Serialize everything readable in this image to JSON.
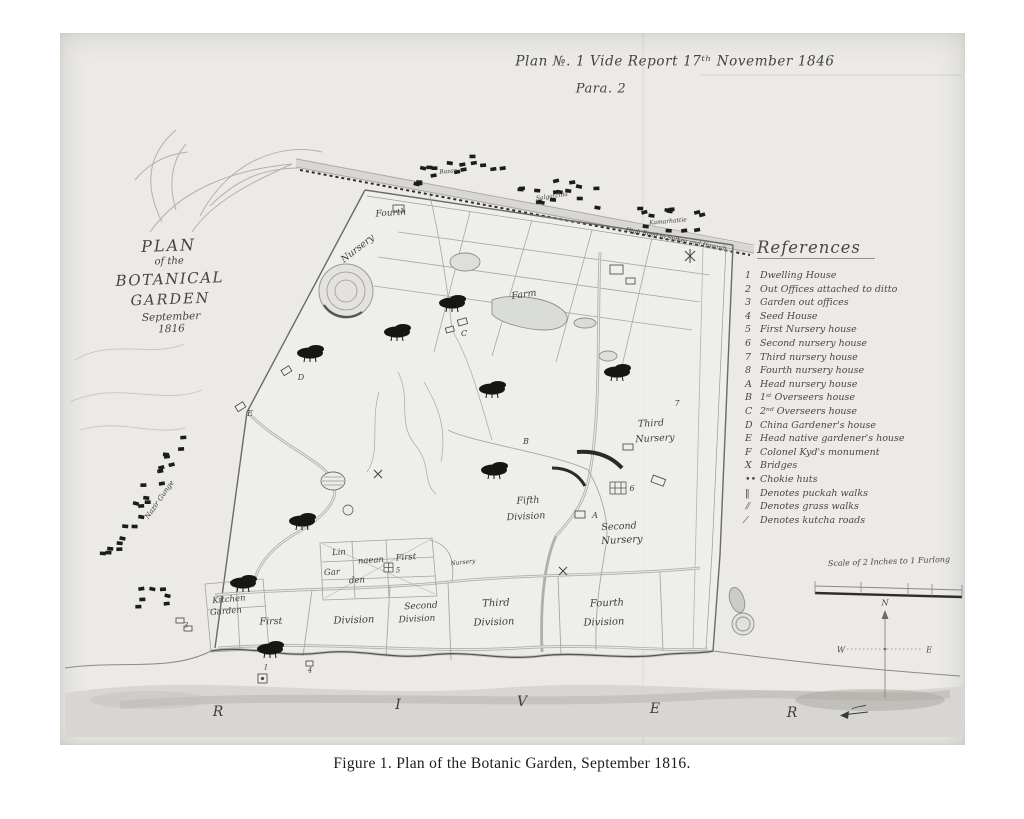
{
  "header": {
    "line1": "Plan №. 1 Vide Report 17ᵗʰ November 1846",
    "line2": "Para. 2"
  },
  "title_block": {
    "lines": [
      "PLAN",
      "of the",
      "BOTANICAL",
      "GARDEN",
      "September",
      "1816"
    ]
  },
  "references": {
    "heading": "References",
    "items": [
      {
        "key": "1",
        "text": "Dwelling House"
      },
      {
        "key": "2",
        "text": "Out Offices attached to ditto"
      },
      {
        "key": "3",
        "text": "Garden out offices"
      },
      {
        "key": "4",
        "text": "Seed House"
      },
      {
        "key": "5",
        "text": "First Nursery house"
      },
      {
        "key": "6",
        "text": "Second nursery house"
      },
      {
        "key": "7",
        "text": "Third nursery house"
      },
      {
        "key": "8",
        "text": "Fourth nursery house"
      },
      {
        "key": "A",
        "text": "Head nursery house"
      },
      {
        "key": "B",
        "text": "1ˢᵗ Overseers house"
      },
      {
        "key": "C",
        "text": "2ⁿᵈ Overseers house"
      },
      {
        "key": "D",
        "text": "China Gardener's house"
      },
      {
        "key": "E",
        "text": "Head native gardener's house"
      },
      {
        "key": "F",
        "text": "Colonel Kyd's monument"
      },
      {
        "key": "X",
        "text": "Bridges"
      },
      {
        "key": "••",
        "text": "Chokie huts"
      },
      {
        "key": "‖",
        "text": "Denotes puckah walks"
      },
      {
        "key": "⫽",
        "text": "Denotes grass walks"
      },
      {
        "key": "⁄",
        "text": "Denotes kutcha roads"
      }
    ]
  },
  "scale": {
    "label": "Scale of 2 Inches to 1 Furlong"
  },
  "compass": {
    "north": "N",
    "west": "W",
    "east": "E"
  },
  "caption": "Figure 1. Plan of the Botanic Garden, September 1816.",
  "map": {
    "labels": [
      {
        "t": "Fourth",
        "x": 391,
        "y": 214,
        "fs": 9,
        "r": -4
      },
      {
        "t": "Nursery",
        "x": 358,
        "y": 249,
        "fs": 9.5,
        "r": -38
      },
      {
        "t": "Farm",
        "x": 524,
        "y": 295,
        "fs": 9.5,
        "r": -8
      },
      {
        "t": "C",
        "x": 464,
        "y": 334,
        "fs": 8,
        "r": 0
      },
      {
        "t": "D",
        "x": 301,
        "y": 378,
        "fs": 8,
        "r": 0
      },
      {
        "t": "E",
        "x": 250,
        "y": 414,
        "fs": 8,
        "r": 0
      },
      {
        "t": "B",
        "x": 526,
        "y": 442,
        "fs": 8,
        "r": 0
      },
      {
        "t": "7",
        "x": 677,
        "y": 404,
        "fs": 8,
        "r": 0
      },
      {
        "t": "Third",
        "x": 651,
        "y": 424,
        "fs": 9.5,
        "r": -3
      },
      {
        "t": "Nursery",
        "x": 655,
        "y": 439,
        "fs": 9.5,
        "r": -3
      },
      {
        "t": "Fifth",
        "x": 528,
        "y": 501,
        "fs": 9.5,
        "r": -3
      },
      {
        "t": "Division",
        "x": 526,
        "y": 517,
        "fs": 9.5,
        "r": -3
      },
      {
        "t": "6",
        "x": 632,
        "y": 489,
        "fs": 8,
        "r": 0
      },
      {
        "t": "A",
        "x": 595,
        "y": 516,
        "fs": 8,
        "r": 0
      },
      {
        "t": "Second",
        "x": 619,
        "y": 527,
        "fs": 9.5,
        "r": -3
      },
      {
        "t": "Nursery",
        "x": 622,
        "y": 541,
        "fs": 10,
        "r": -3
      },
      {
        "t": "Lin",
        "x": 339,
        "y": 553,
        "fs": 8.5,
        "r": -4
      },
      {
        "t": "naean",
        "x": 371,
        "y": 561,
        "fs": 8.5,
        "r": -4
      },
      {
        "t": "Gar",
        "x": 332,
        "y": 573,
        "fs": 8.5,
        "r": -4
      },
      {
        "t": "den",
        "x": 357,
        "y": 581,
        "fs": 8.5,
        "r": -4
      },
      {
        "t": "First",
        "x": 406,
        "y": 558,
        "fs": 8.5,
        "r": -4
      },
      {
        "t": "5",
        "x": 398,
        "y": 571,
        "fs": 7,
        "r": 0
      },
      {
        "t": "Nursery",
        "x": 463,
        "y": 563,
        "fs": 6,
        "r": -6
      },
      {
        "t": "Kitchen",
        "x": 229,
        "y": 600,
        "fs": 8.5,
        "r": -5
      },
      {
        "t": "Garden",
        "x": 226,
        "y": 612,
        "fs": 8.5,
        "r": -5
      },
      {
        "t": "First",
        "x": 271,
        "y": 622,
        "fs": 9.5,
        "r": -2
      },
      {
        "t": "Division",
        "x": 354,
        "y": 621,
        "fs": 10,
        "r": -2
      },
      {
        "t": "Second",
        "x": 421,
        "y": 607,
        "fs": 9,
        "r": -3
      },
      {
        "t": "Division",
        "x": 417,
        "y": 620,
        "fs": 9,
        "r": -3
      },
      {
        "t": "Third",
        "x": 496,
        "y": 604,
        "fs": 10,
        "r": -2
      },
      {
        "t": "Division",
        "x": 494,
        "y": 623,
        "fs": 10,
        "r": -2
      },
      {
        "t": "Fourth",
        "x": 607,
        "y": 604,
        "fs": 10,
        "r": -2
      },
      {
        "t": "Division",
        "x": 604,
        "y": 623,
        "fs": 10,
        "r": -2
      },
      {
        "t": "R",
        "x": 218,
        "y": 712,
        "fs": 14,
        "r": 0
      },
      {
        "t": "I",
        "x": 398,
        "y": 705,
        "fs": 14,
        "r": 0
      },
      {
        "t": "V",
        "x": 522,
        "y": 702,
        "fs": 14,
        "r": 0
      },
      {
        "t": "E",
        "x": 655,
        "y": 709,
        "fs": 14,
        "r": 0
      },
      {
        "t": "R",
        "x": 792,
        "y": 713,
        "fs": 14,
        "r": 0
      },
      {
        "t": "Nazir Gunge",
        "x": 160,
        "y": 500,
        "fs": 7,
        "r": -55
      },
      {
        "t": "Bazar",
        "x": 448,
        "y": 172,
        "fs": 6,
        "r": -5
      },
      {
        "t": "Salgatchia",
        "x": 552,
        "y": 197,
        "fs": 6,
        "r": -8
      },
      {
        "t": "Kamarhattie",
        "x": 668,
        "y": 222,
        "fs": 6,
        "r": -5
      },
      {
        "t": "High Road to Sulkea and Howrah",
        "x": 676,
        "y": 240,
        "fs": 6,
        "r": 11
      },
      {
        "t": "1",
        "x": 266,
        "y": 668,
        "fs": 7,
        "r": 0
      },
      {
        "t": "3",
        "x": 186,
        "y": 626,
        "fs": 7,
        "r": 0
      },
      {
        "t": "4",
        "x": 310,
        "y": 671,
        "fs": 7,
        "r": 0
      }
    ]
  },
  "colors": {
    "paper": "#ebeae6",
    "ink": "#3e3d39",
    "hut": "#1c1c18",
    "river_wash": "#d7d6d2"
  }
}
